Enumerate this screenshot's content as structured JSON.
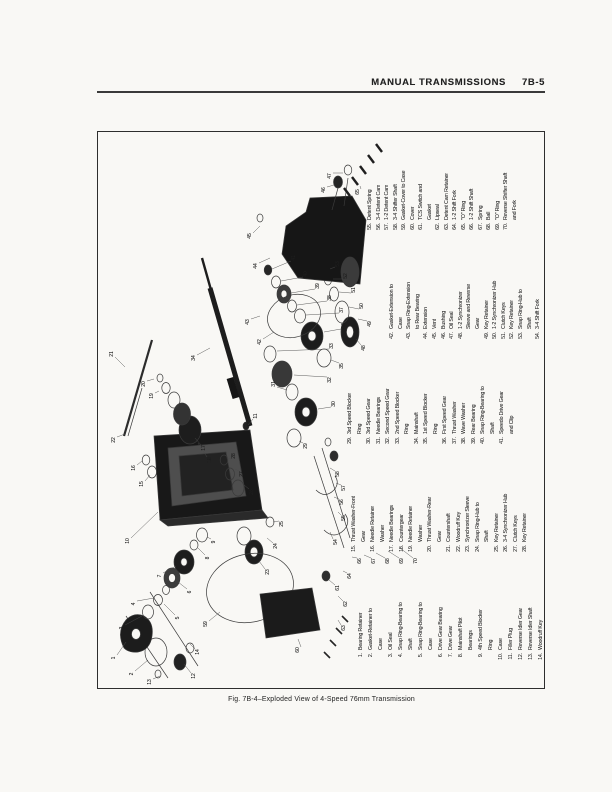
{
  "header": {
    "title": "MANUAL TRANSMISSIONS",
    "page_number": "7B-5"
  },
  "figure": {
    "caption": "Fig. 7B-4–Exploded View of 4-Speed 76mm Transmission"
  },
  "legend": {
    "columns": [
      {
        "items": [
          {
            "n": "1.",
            "lines": [
              "Bearing Retainer"
            ]
          },
          {
            "n": "2.",
            "lines": [
              "Gasket-Retainer to",
              "Case"
            ]
          },
          {
            "n": "3.",
            "lines": [
              "Oil Seal"
            ]
          },
          {
            "n": "4.",
            "lines": [
              "Snap Ring-Bearing to",
              "Shaft"
            ]
          },
          {
            "n": "5.",
            "lines": [
              "Snap Ring-Bearing to",
              "Case"
            ]
          },
          {
            "n": "6.",
            "lines": [
              "Drive Gear Bearing"
            ]
          },
          {
            "n": "7.",
            "lines": [
              "Drive Gear"
            ]
          },
          {
            "n": "8.",
            "lines": [
              "Mainshaft Pilot",
              "Bearings"
            ]
          },
          {
            "n": "9.",
            "lines": [
              "4th Speed Blocker",
              "Ring"
            ]
          },
          {
            "n": "10.",
            "lines": [
              "Case"
            ]
          },
          {
            "n": "11.",
            "lines": [
              "Filler Plug"
            ]
          },
          {
            "n": "12.",
            "lines": [
              "Reverse Idler Gear"
            ]
          },
          {
            "n": "13.",
            "lines": [
              "Reverse Idler Shaft"
            ]
          },
          {
            "n": "14.",
            "lines": [
              "Woodruff Key"
            ]
          }
        ]
      },
      {
        "items": [
          {
            "n": "15.",
            "lines": [
              "Thrust Washer-Front",
              "Gear"
            ]
          },
          {
            "n": "16.",
            "lines": [
              "Needle Retainer",
              "Washer"
            ]
          },
          {
            "n": "17.",
            "lines": [
              "Needle Bearings"
            ]
          },
          {
            "n": "18.",
            "lines": [
              "Countergear"
            ]
          },
          {
            "n": "19.",
            "lines": [
              "Needle Retainer",
              "Washer"
            ]
          },
          {
            "n": "20.",
            "lines": [
              "Thrust Washer-Rear",
              "Gear"
            ]
          },
          {
            "n": "21.",
            "lines": [
              "Countershaft"
            ]
          },
          {
            "n": "22.",
            "lines": [
              "Woodruff Key"
            ]
          },
          {
            "n": "23.",
            "lines": [
              "Synchronizer Sleeve"
            ]
          },
          {
            "n": "24.",
            "lines": [
              "Snap Ring-Hub to",
              "Shaft"
            ]
          },
          {
            "n": "25.",
            "lines": [
              "Key Retainer"
            ]
          },
          {
            "n": "26.",
            "lines": [
              "3-4 Synchronizer Hub"
            ]
          },
          {
            "n": "27.",
            "lines": [
              "Clutch Keys"
            ]
          },
          {
            "n": "28.",
            "lines": [
              "Key Retainer"
            ]
          }
        ]
      },
      {
        "items": [
          {
            "n": "29.",
            "lines": [
              "3rd Speed Blocker",
              "Ring"
            ]
          },
          {
            "n": "30.",
            "lines": [
              "3rd Speed Gear"
            ]
          },
          {
            "n": "31.",
            "lines": [
              "Needle Bearings"
            ]
          },
          {
            "n": "32.",
            "lines": [
              "Second Speed Gear"
            ]
          },
          {
            "n": "33.",
            "lines": [
              "2nd Speed Blocker",
              "Ring"
            ]
          },
          {
            "n": "34.",
            "lines": [
              "Mainshaft"
            ]
          },
          {
            "n": "35.",
            "lines": [
              "1st Speed Blocker",
              "Ring"
            ]
          },
          {
            "n": "36.",
            "lines": [
              "First Speed Gear"
            ]
          },
          {
            "n": "37.",
            "lines": [
              "Thrust Washer"
            ]
          },
          {
            "n": "38.",
            "lines": [
              "Wave Washer"
            ]
          },
          {
            "n": "39.",
            "lines": [
              "Rear Bearing"
            ]
          },
          {
            "n": "40.",
            "lines": [
              "Snap Ring-Bearing to",
              "Shaft"
            ]
          },
          {
            "n": "41.",
            "lines": [
              "Speedo Drive Gear",
              "and Clip"
            ]
          }
        ]
      },
      {
        "items": [
          {
            "n": "42.",
            "lines": [
              "Gasket-Extension to",
              "Case"
            ]
          },
          {
            "n": "43.",
            "lines": [
              "Snap Ring-Extension",
              "to Rear Bearing"
            ]
          },
          {
            "n": "44.",
            "lines": [
              "Extension"
            ]
          },
          {
            "n": "45.",
            "lines": [
              "Vent"
            ]
          },
          {
            "n": "46.",
            "lines": [
              "Bushing"
            ]
          },
          {
            "n": "47.",
            "lines": [
              "Oil Seal"
            ]
          },
          {
            "n": "48.",
            "lines": [
              "1-2 Synchronizer",
              "Sleeve and Reverse",
              "Gear"
            ]
          },
          {
            "n": "49.",
            "lines": [
              "Key Retainer"
            ]
          },
          {
            "n": "50.",
            "lines": [
              "1-2 Synchronizer Hub"
            ]
          },
          {
            "n": "51.",
            "lines": [
              "Clutch Keys"
            ]
          },
          {
            "n": "52.",
            "lines": [
              "Key Retainer"
            ]
          },
          {
            "n": "53.",
            "lines": [
              "Snap Ring-Hub to",
              "Shaft"
            ]
          },
          {
            "n": "54.",
            "lines": [
              "3-4 Shift Fork"
            ]
          }
        ]
      },
      {
        "items": [
          {
            "n": "55.",
            "lines": [
              "Detent Spring"
            ]
          },
          {
            "n": "56.",
            "lines": [
              "3-4 Detent Cam"
            ]
          },
          {
            "n": "57.",
            "lines": [
              "1-2 Detent Cam"
            ]
          },
          {
            "n": "58.",
            "lines": [
              "3-4 Shifter Shaft"
            ]
          },
          {
            "n": "59.",
            "lines": [
              "Gasket-Cover to Case"
            ]
          },
          {
            "n": "60.",
            "lines": [
              "Cover"
            ]
          },
          {
            "n": "61.",
            "lines": [
              "TCS Switch and",
              "Gasket"
            ]
          },
          {
            "n": "62.",
            "lines": [
              "Lipseal"
            ]
          },
          {
            "n": "63.",
            "lines": [
              "Detent Cam Retainer"
            ]
          },
          {
            "n": "64.",
            "lines": [
              "1-2 Shift Fork"
            ]
          },
          {
            "n": "65.",
            "lines": [
              "\"O\" Ring"
            ]
          },
          {
            "n": "66.",
            "lines": [
              "1-2 Shift Shaft"
            ]
          },
          {
            "n": "67.",
            "lines": [
              "Spring"
            ]
          },
          {
            "n": "68.",
            "lines": [
              "Ball"
            ]
          },
          {
            "n": "69.",
            "lines": [
              "\"O\" Ring"
            ]
          },
          {
            "n": "70.",
            "lines": [
              "Reverse Shifter Shaft",
              "and Fork"
            ]
          }
        ]
      }
    ]
  },
  "callouts": [
    "1",
    "2",
    "3",
    "4",
    "5",
    "6",
    "7",
    "8",
    "9",
    "10",
    "11",
    "12",
    "13",
    "14",
    "15",
    "16",
    "17",
    "18",
    "19",
    "20",
    "21",
    "22",
    "23",
    "24",
    "25",
    "26",
    "27",
    "28",
    "29",
    "30",
    "31",
    "32",
    "33",
    "34",
    "35",
    "36",
    "37",
    "38",
    "39",
    "40",
    "41",
    "42",
    "43",
    "44",
    "45",
    "46",
    "47",
    "48",
    "49",
    "50",
    "51",
    "52",
    "53",
    "54",
    "55",
    "56",
    "57",
    "58",
    "59",
    "60",
    "61",
    "62",
    "63",
    "64",
    "65",
    "66",
    "67",
    "68",
    "69",
    "70"
  ]
}
